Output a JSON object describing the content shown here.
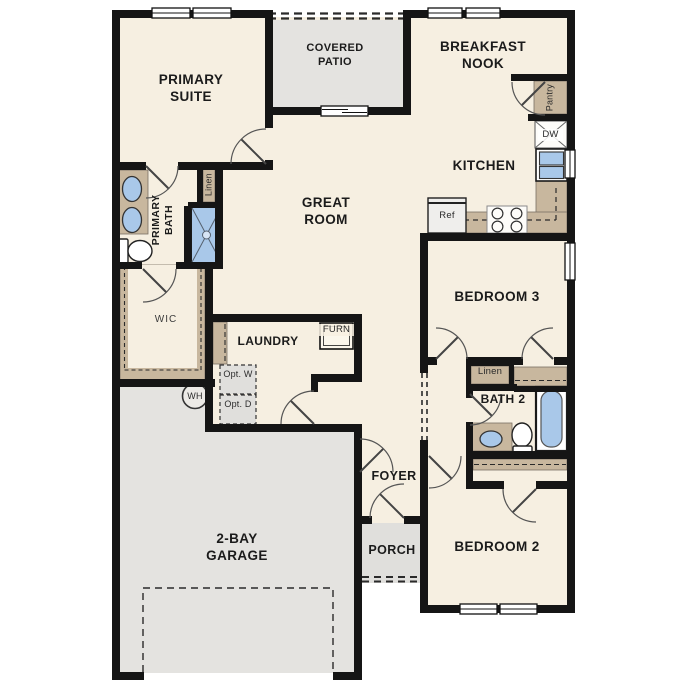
{
  "plan": {
    "type": "single-story residential floor plan",
    "labels": {
      "primary_suite": "PRIMARY SUITE",
      "covered_patio": "COVERED PATIO",
      "breakfast_nook": "BREAKFAST NOOK",
      "kitchen": "KITCHEN",
      "great_room": "GREAT ROOM",
      "primary_bath": "PRIMARY BATH",
      "linen_primary": "Linen",
      "pantry": "Pantry",
      "dw": "DW",
      "ref": "Ref",
      "furn": "FURN",
      "laundry": "LAUNDRY",
      "opt_w": "Opt. W",
      "opt_d": "Opt. D",
      "wh": "WH",
      "wic": "WIC",
      "bedroom3": "BEDROOM 3",
      "linen_hall": "Linen",
      "bath2": "BATH 2",
      "foyer": "FOYER",
      "porch": "PORCH",
      "bedroom2": "BEDROOM 2",
      "garage": "2-BAY GARAGE"
    },
    "colors": {
      "floor_cream": "#f6efe1",
      "wall_black": "#151515",
      "cabinetry_tan": "#c8b79e",
      "fixture_blue": "#a9c8e9",
      "concrete_gray": "#e4e3e0",
      "optional_box_gray": "#e0dfdc"
    }
  }
}
